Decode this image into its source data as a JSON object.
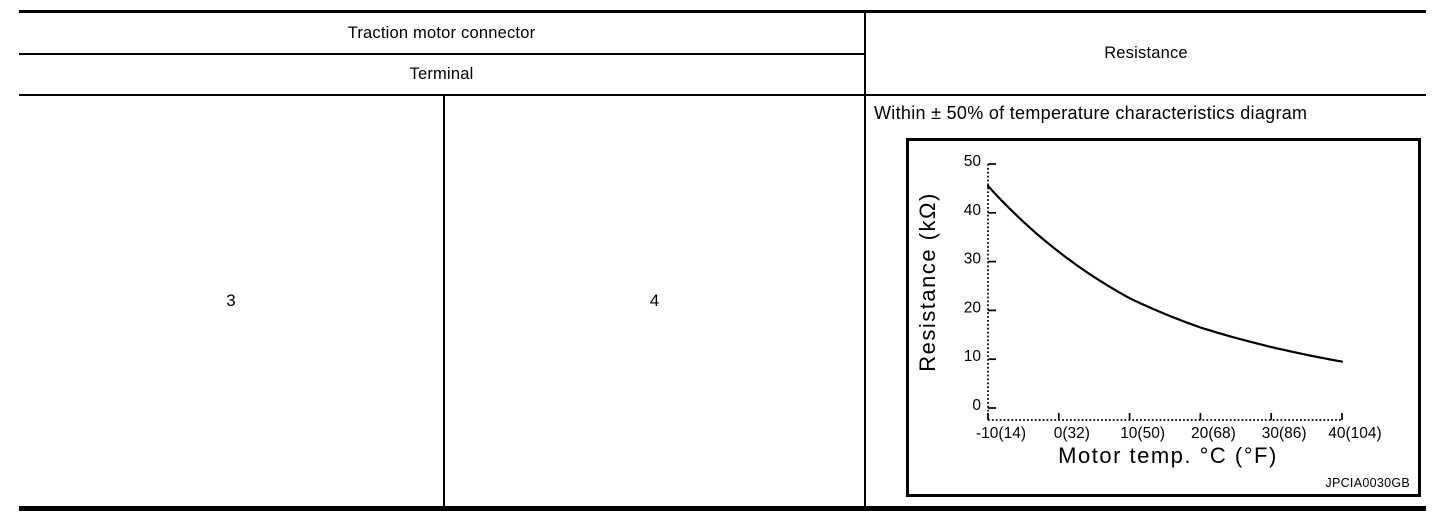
{
  "table": {
    "header": {
      "group_label": "Traction motor connector",
      "sub_label": "Terminal",
      "resistance_label": "Resistance"
    },
    "body": {
      "terminal_1": "3",
      "terminal_2": "4",
      "resistance_spec": "Within ± 50% of temperature characteristics diagram"
    }
  },
  "chart_data": {
    "type": "line",
    "title": "",
    "xlabel": "Motor temp. °C (°F)",
    "ylabel": "Resistance (kΩ)",
    "x": [
      -10,
      0,
      10,
      20,
      30,
      40
    ],
    "series": [
      {
        "name": "thermistor-resistance",
        "values_kohm": [
          45.5,
          32,
          22.5,
          16.5,
          12.5,
          9.5
        ]
      }
    ],
    "x_tick_labels": [
      "-10(14)",
      "0(32)",
      "10(50)",
      "20(68)",
      "30(86)",
      "40(104)"
    ],
    "y_tick_labels": [
      "0",
      "10",
      "20",
      "30",
      "40",
      "50"
    ],
    "xlim": [
      -10,
      40
    ],
    "ylim": [
      0,
      50
    ],
    "grid": false,
    "legend": null,
    "watermark": "JPCIA0030GB",
    "line_color": "#000000"
  },
  "colors": {
    "border": "#000000",
    "background": "#ffffff",
    "text": "#000000"
  }
}
